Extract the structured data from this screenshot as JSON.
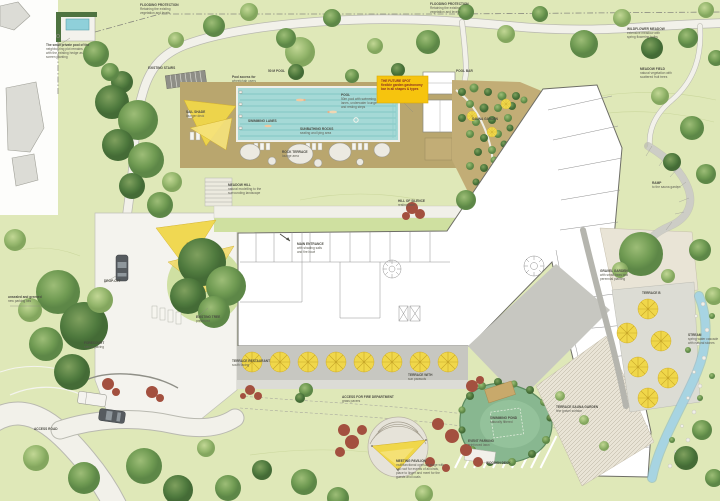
{
  "colors": {
    "lawn": "#dfe8b8",
    "pool_water": "#a5d9d6",
    "deck_tan": "#b9a66e",
    "terrace_gray": "#c7c7c1",
    "accent_yellow": "#f0d74a",
    "note_yellow": "#f6c40e",
    "note_text": "#8b2f22",
    "pond_water": "#88b790",
    "stream_blue": "#a7d4e2",
    "red_shrub": "#a3503f",
    "building_white": "#ffffff",
    "label_gray": "#5e5e54"
  },
  "plan": {
    "labels": [
      {
        "x": 140,
        "y": 3,
        "text": "FLOODING PROTECTION\nRetaining the existing\nvegetation and levels"
      },
      {
        "x": 430,
        "y": 2,
        "text": "FLOODING PROTECTION\nRetaining the existing\nvegetation and levels"
      },
      {
        "x": 627,
        "y": 27,
        "text": "WILDFLOWER MEADOW\nextensive meadow with\nspring flowering bulbs"
      },
      {
        "x": 640,
        "y": 67,
        "text": "MEADOW FIELD\nnatural vegetation with\nscattered fruit trees"
      },
      {
        "x": 46,
        "y": 43,
        "text": "The small private pool of the\nneighbouring plot remains\nwith the existing hedge as\nscreen planting"
      },
      {
        "x": 148,
        "y": 66,
        "text": "EXISTING STAIRS"
      },
      {
        "x": 232,
        "y": 75,
        "text": "Pool access for\nwheelchair users"
      },
      {
        "x": 268,
        "y": 69,
        "text": "50 M POOL"
      },
      {
        "x": 341,
        "y": 93,
        "text": "POOL\n50m pool with swimming\nlanes, underwater lounge\nand resting steps"
      },
      {
        "x": 248,
        "y": 119,
        "text": "SWIMMING LANES"
      },
      {
        "x": 300,
        "y": 127,
        "text": "SUNBATHING ROCKS\nseating and lying area"
      },
      {
        "x": 282,
        "y": 150,
        "text": "ROCK TERRACE\nlounge area"
      },
      {
        "x": 186,
        "y": 110,
        "text": "SAIL SHADE\nlounger deck"
      },
      {
        "x": 456,
        "y": 69,
        "text": "POOL BAR"
      },
      {
        "x": 381,
        "y": 79,
        "cls": "note",
        "text": "THE FUTURE SPOT\nflexible garden gastronomy\nbar in all shapes & types"
      },
      {
        "x": 472,
        "y": 117,
        "text": "SAUNA GARDEN"
      },
      {
        "x": 228,
        "y": 183,
        "text": "MEADOW HILL\nnatural modelling to the\nsurrounding landscape"
      },
      {
        "x": 398,
        "y": 199,
        "text": "HILL OF SILENCE\nresting lawn"
      },
      {
        "x": 297,
        "y": 242,
        "text": "MAIN ENTRANCE\nwith shading sails\nand fire bowl"
      },
      {
        "x": 104,
        "y": 279,
        "text": "DROP-OFF"
      },
      {
        "x": 196,
        "y": 315,
        "text": "EXISTING TREE\npreserved"
      },
      {
        "x": 8,
        "y": 295,
        "text": "unsealed and greened\nnew parking lots"
      },
      {
        "x": 84,
        "y": 341,
        "text": "FORECOURT\nnatural paving"
      },
      {
        "x": 232,
        "y": 359,
        "text": "TERRACE RESTAURANT\nsouth facing"
      },
      {
        "x": 408,
        "y": 373,
        "text": "TERRACE WITH\nsun parasols"
      },
      {
        "x": 342,
        "y": 395,
        "text": "ACCESS FOR FIRE DEPARTMENT\ngrass pavers"
      },
      {
        "x": 34,
        "y": 427,
        "text": "ACCESS ROAD"
      },
      {
        "x": 396,
        "y": 459,
        "text": "MEETING PAVILION\nmultifunctional open-air stage with\nsail roof for events of all kinds,\nplace to linger and meet for the\nguests and locals"
      },
      {
        "x": 468,
        "y": 439,
        "text": "EVENT PARKING\nreinforced lawn"
      },
      {
        "x": 490,
        "y": 416,
        "text": "SWIMMING POND\nnaturally filtered"
      },
      {
        "x": 486,
        "y": 461,
        "text": "WOODEN DECK"
      },
      {
        "x": 556,
        "y": 405,
        "text": "TERRACE SAUNA GARDEN\nfine gravel surface"
      },
      {
        "x": 600,
        "y": 269,
        "text": "GRAVEL GARDEN\nwith small trees and\nperennial planting"
      },
      {
        "x": 642,
        "y": 291,
        "text": "TERRACE B"
      },
      {
        "x": 688,
        "y": 333,
        "text": "STREAM\nspring water cascade\nwith natural stones"
      },
      {
        "x": 652,
        "y": 181,
        "text": "RAMP\nto the sauna garden"
      }
    ]
  }
}
